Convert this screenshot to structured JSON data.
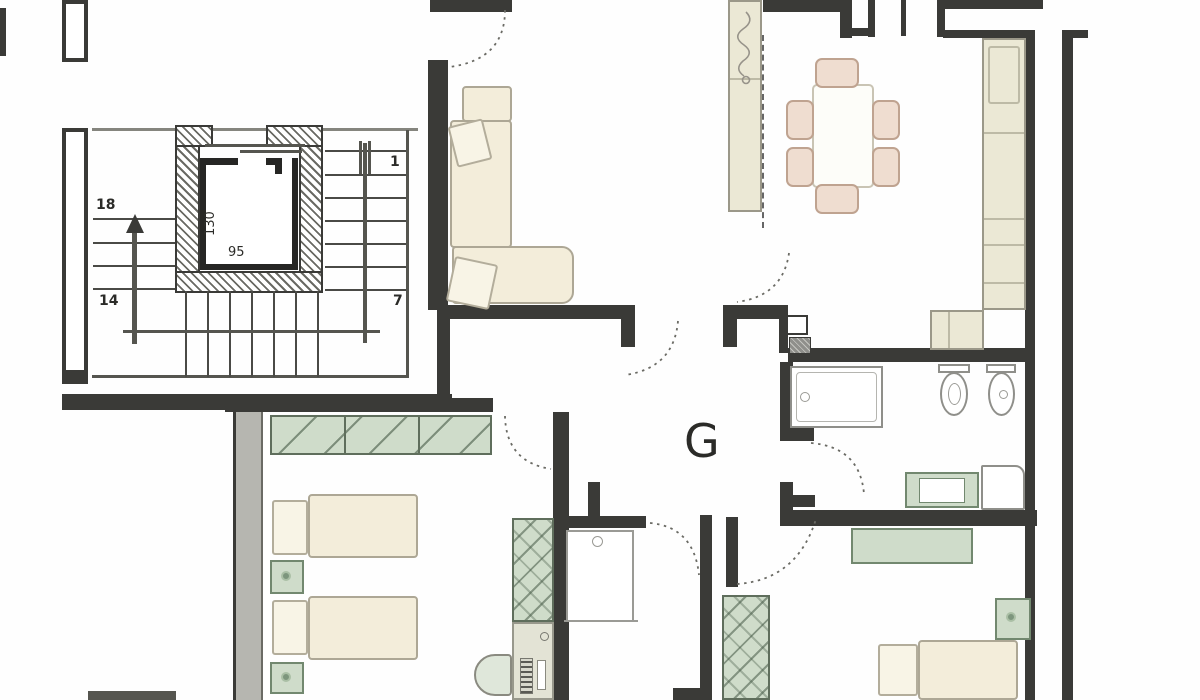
{
  "plan": {
    "unit_label": "G",
    "stair_labels": {
      "upper_left": "18",
      "lower_left": "14",
      "upper_right": "1",
      "lower_right": "7"
    },
    "elevator_labels": {
      "depth": "130",
      "width": "95"
    }
  },
  "colors": {
    "wall": "#3a3a37",
    "poche_gray": "#b6b6b0",
    "furniture_beige": "#f3edda",
    "furniture_green": "#cfdcca",
    "chair_pink": "#efddd0",
    "counter": "#ebe8d5",
    "paper": "#fefefe"
  }
}
